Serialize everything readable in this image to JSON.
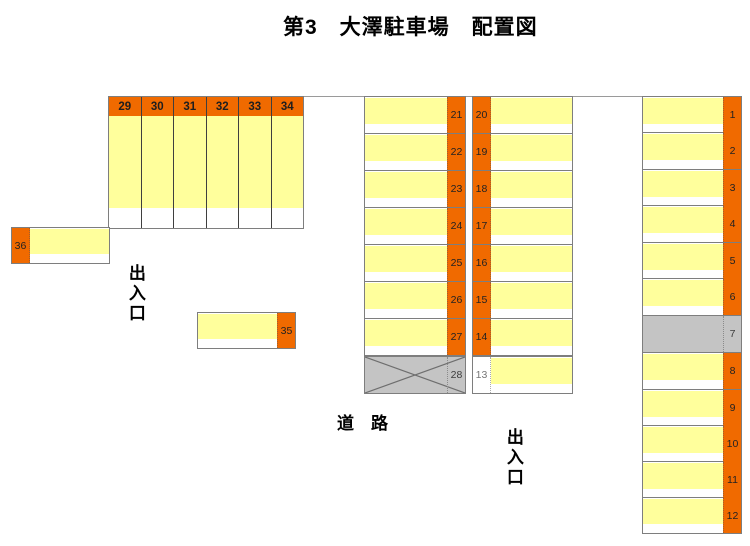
{
  "title": "第3　大澤駐車場　配置図",
  "texts": {
    "entrance_left": "出入口",
    "entrance_right": "出入口",
    "road": "道　路"
  },
  "colors": {
    "stall_label_orange": "#F06A00",
    "stall_fill_yellow": "#FFFF9C",
    "unavailable_gray": "#C4C4C4",
    "border_gray": "#7E7E7E"
  },
  "stalls": {
    "top_row": [
      "29",
      "30",
      "31",
      "32",
      "33",
      "34"
    ],
    "left_single": "36",
    "mid_single": "35",
    "column_a": [
      "21",
      "22",
      "23",
      "24",
      "25",
      "26",
      "27",
      "28"
    ],
    "column_b": [
      "20",
      "19",
      "18",
      "17",
      "16",
      "15",
      "14",
      "13"
    ],
    "right_column": [
      "1",
      "2",
      "3",
      "4",
      "5",
      "6",
      "7",
      "8",
      "9",
      "10",
      "11",
      "12"
    ],
    "unavailable_stalls": [
      "28",
      "7"
    ],
    "white_label_stalls": [
      "13"
    ]
  }
}
